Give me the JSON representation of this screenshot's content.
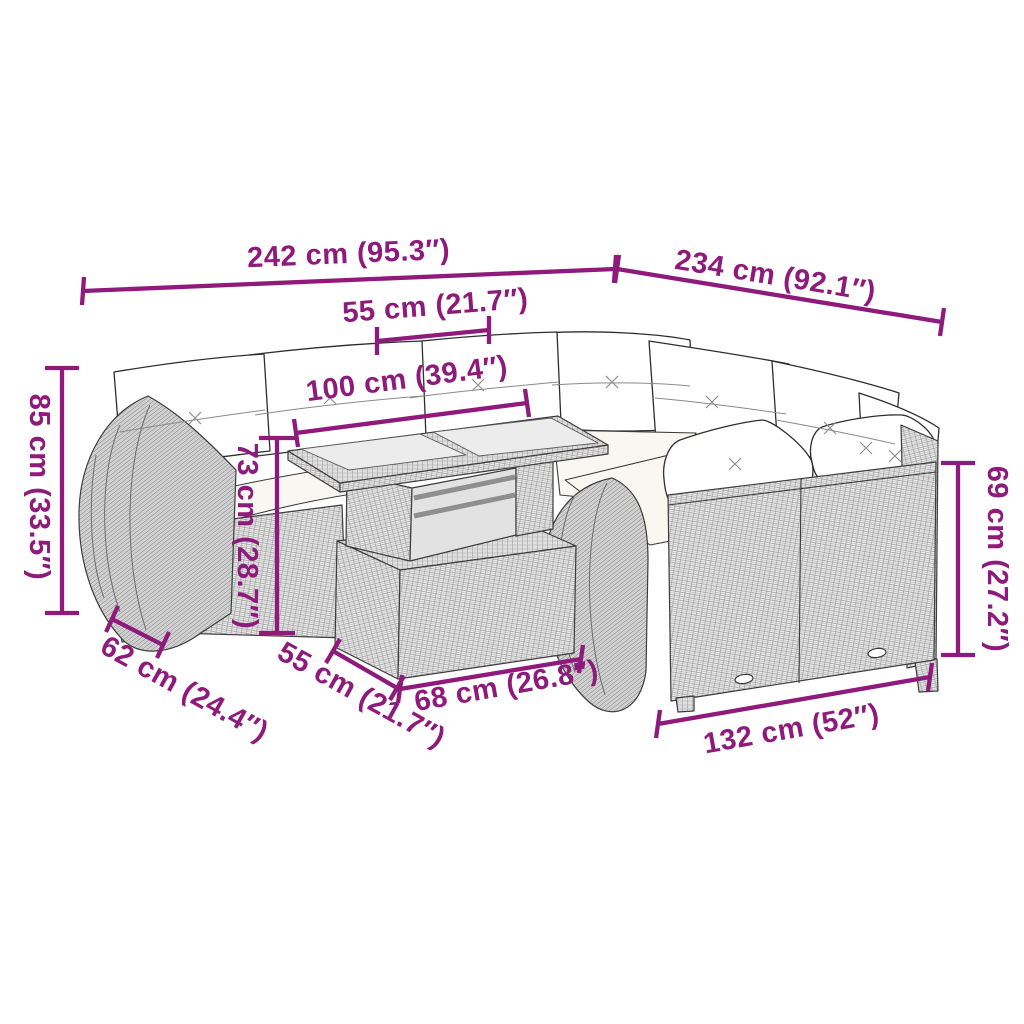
{
  "figure": {
    "kind": "furniture-dimension-diagram",
    "background_color": "#ffffff",
    "accent_color": "#8e1a7c",
    "line_art_color": "#3c3c3c",
    "dimensions": [
      {
        "name": "back-width-left",
        "label": "242 cm (95.3″)"
      },
      {
        "name": "back-width-right",
        "label": "234 cm (92.1″)"
      },
      {
        "name": "seat-width",
        "label": "55 cm (21.7″)"
      },
      {
        "name": "table-length",
        "label": "100 cm (39.4″)"
      },
      {
        "name": "total-height-left",
        "label": "85 cm (33.5″)"
      },
      {
        "name": "table-height",
        "label": "73 cm (28.7″)"
      },
      {
        "name": "back-height-right",
        "label": "69 cm (27.2″)"
      },
      {
        "name": "armrest-depth",
        "label": "62 cm (24.4″)"
      },
      {
        "name": "seat-depth",
        "label": "55 cm (21.7″)"
      },
      {
        "name": "table-width",
        "label": "68 cm (26.8″)"
      },
      {
        "name": "front-width",
        "label": "132 cm (52″)"
      }
    ]
  }
}
